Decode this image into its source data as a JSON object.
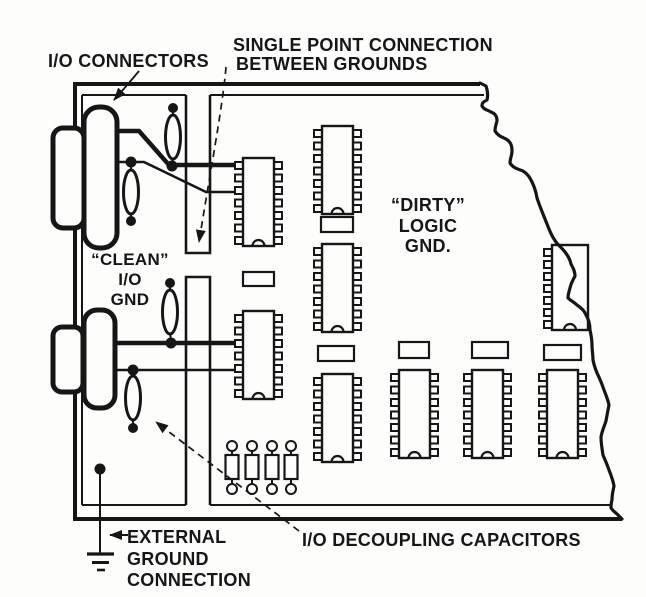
{
  "figure": {
    "type": "circuit-board-grounding-diagram",
    "colors": {
      "ink": "#161616",
      "paper": "#fdfdfc"
    },
    "labels": {
      "io_connectors": "I/O CONNECTORS",
      "single_point_line1": "SINGLE POINT CONNECTION",
      "single_point_line2": "BETWEEN GROUNDS",
      "clean_line1": "“CLEAN”",
      "clean_line2": "I/O",
      "clean_line3": "GND",
      "dirty_line1": "“DIRTY”",
      "dirty_line2": "LOGIC",
      "dirty_line3": "GND.",
      "external_line1": "EXTERNAL",
      "external_line2": "GROUND",
      "external_line3": "CONNECTION",
      "decoupling": "I/O DECOUPLING CAPACITORS"
    },
    "inventory": {
      "io_connectors": 2,
      "dip_ics": 9,
      "bypass_capacitors": 6,
      "axial_components": 4,
      "io_decoupling_capacitors": 4,
      "ground_symbols": 1
    }
  }
}
